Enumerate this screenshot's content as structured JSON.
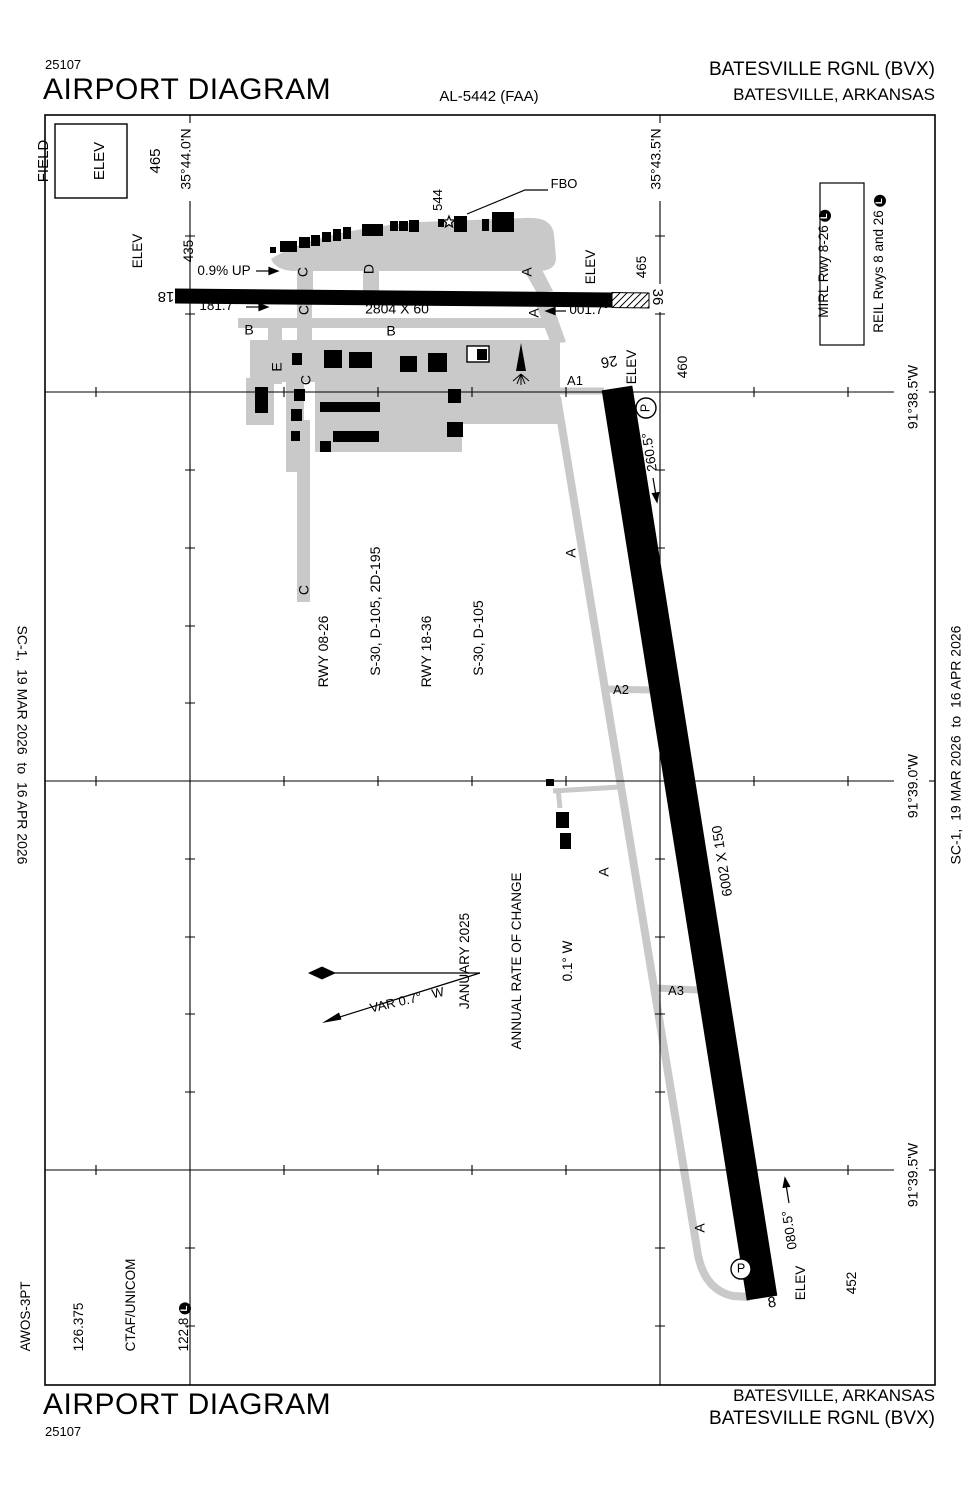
{
  "header": {
    "print_code": "25107",
    "title": "AIRPORT DIAGRAM",
    "chart_number": "AL-5442 (FAA)",
    "airport_name": "BATESVILLE RGNL (BVX)",
    "city": "BATESVILLE, ARKANSAS"
  },
  "footer": {
    "title": "AIRPORT DIAGRAM",
    "print_code": "25107",
    "airport_name": "BATESVILLE RGNL (BVX)",
    "city": "BATESVILLE, ARKANSAS"
  },
  "edition": {
    "left": "SC-1,  19 MAR 2026  to  16 APR 2026",
    "right": "SC-1,  19 MAR 2026  to  16 APR 2026"
  },
  "field_elev": {
    "line1": "FIELD",
    "line2": "ELEV",
    "line3": "465"
  },
  "coordinates": {
    "lat": [
      "35°44.0'N",
      "35°43.5'N"
    ],
    "lon": [
      "91°38.5'W",
      "91°39.0'W",
      "91°39.5'W"
    ]
  },
  "lighting": {
    "line1": "MIRL Rwy 8-26",
    "line2": "REIL Rwys 8 and 26",
    "badge": "L"
  },
  "comms": {
    "line1": "AWOS-3PT",
    "line2": "126.375",
    "line3": "CTAF/UNICOM",
    "line4": "122.8",
    "badge": "L"
  },
  "runway_data": {
    "line1": "RWY 08-26",
    "line2": "   S-30, D-105, 2D-195",
    "line3": "RWY 18-36",
    "line4": "   S-30, D-105"
  },
  "magnetic": {
    "line1": "JANUARY 2025",
    "line2": "ANNUAL RATE OF CHANGE",
    "line3": "0.1° W",
    "var_label": "VAR 0.7°   W"
  },
  "runways": {
    "rwy_18_36": {
      "num_18": "18",
      "num_36": "36",
      "dims": "2804 X 60",
      "hdg_18": "181.7°",
      "hdg_36": "001.7°",
      "grade": "0.9% UP",
      "elev_18_l1": "ELEV",
      "elev_18_l2": "435",
      "elev_36_l1": "ELEV",
      "elev_36_l2": "465"
    },
    "rwy_8_26": {
      "num_8": "8",
      "num_26": "26",
      "dims": "6002 X 150",
      "hdg_26": "260.5°",
      "hdg_8": "080.5°",
      "elev_26_l1": "ELEV",
      "elev_26_l2": "460",
      "elev_8_l1": "ELEV",
      "elev_8_l2": "452"
    }
  },
  "taxiways": {
    "a1": "A1",
    "a2": "A2",
    "a3": "A3",
    "a": "A",
    "b": "B",
    "c": "C",
    "d": "D",
    "e": "E"
  },
  "poi": {
    "fbo": "FBO",
    "obstacle_elev": "544",
    "parking": "P"
  }
}
